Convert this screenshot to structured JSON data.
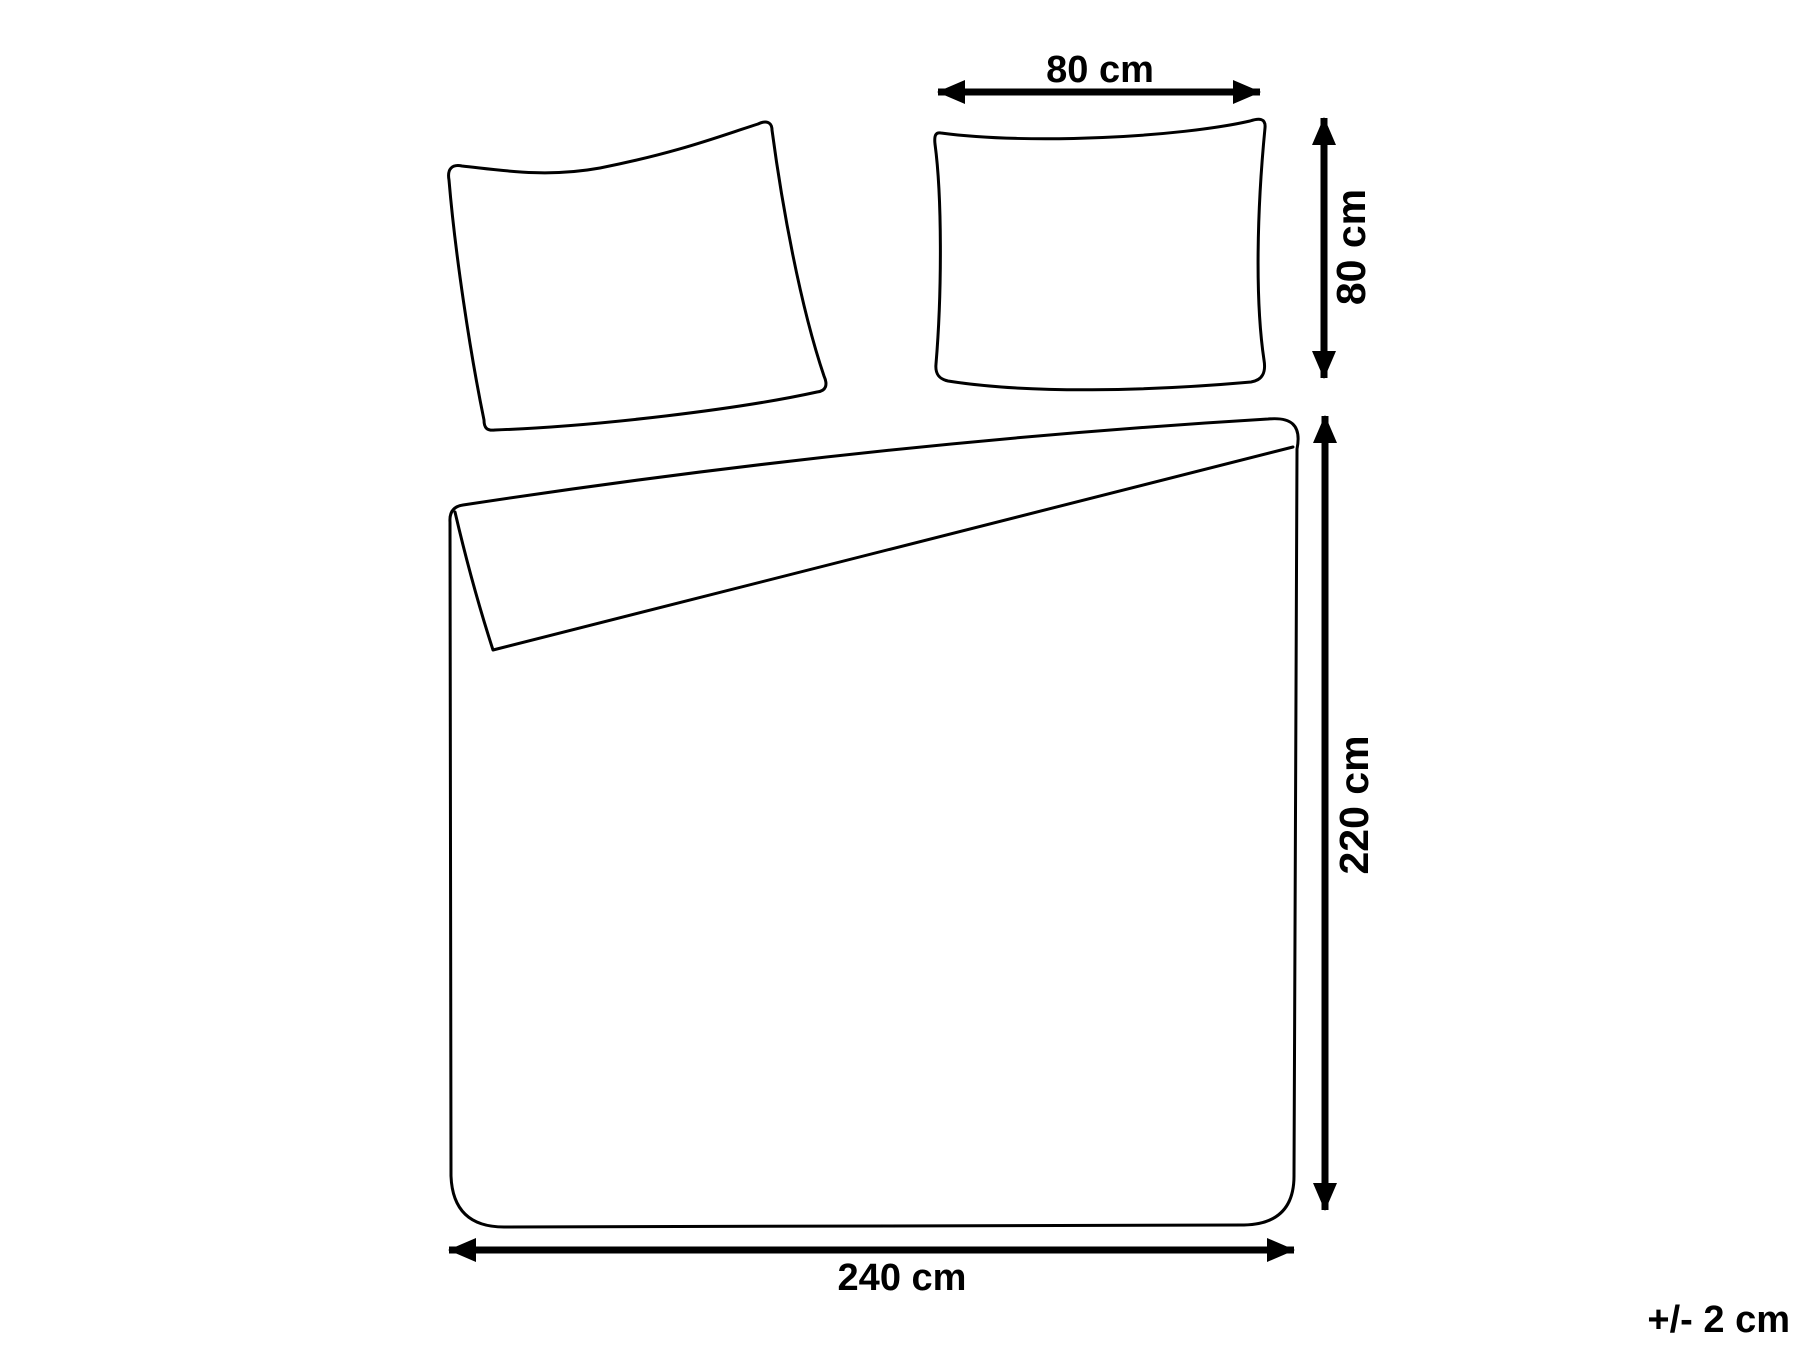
{
  "page": {
    "background_color": "#ffffff",
    "stroke_color": "#000000"
  },
  "diagram": {
    "name": "bedding-set-dimensions",
    "shapes": {
      "left_pillow": "pillow-tilted-outline-icon",
      "right_pillow": "pillow-front-outline-icon",
      "duvet": "duvet-cover-folded-corner-outline-icon"
    },
    "labels": {
      "pillow_width": "80 cm",
      "pillow_height": "80 cm",
      "duvet_height": "220 cm",
      "duvet_width": "240 cm",
      "tolerance": "+/- 2 cm"
    }
  }
}
